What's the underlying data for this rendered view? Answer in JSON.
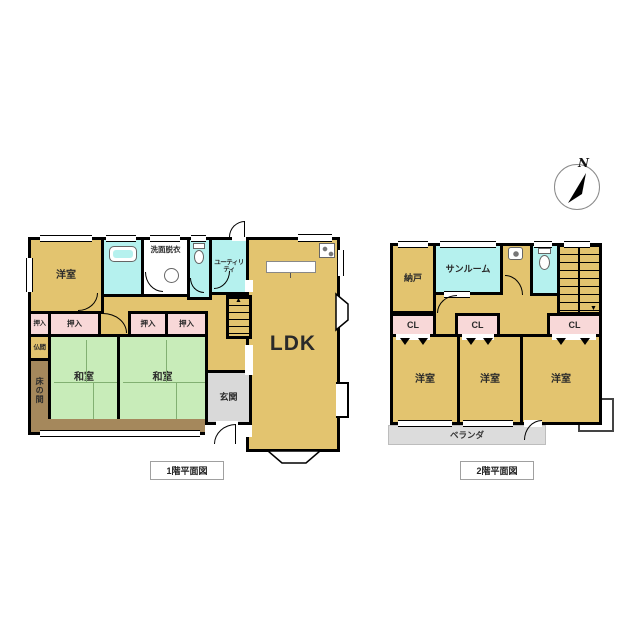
{
  "compass": {
    "label": "N"
  },
  "colors": {
    "wall": "#000000",
    "room_tan": "#e3c46f",
    "tatami_green": "#c8ecb9",
    "closet_pink": "#f8d8d8",
    "wet_cyan": "#b5f1ee",
    "wood_brown": "#a5885c",
    "entry_gray": "#d9d9d9",
    "background": "#ffffff"
  },
  "floor1": {
    "caption": "1階平面図",
    "rooms": {
      "yoshitsu": "洋室",
      "senmen": "洗面脱衣",
      "utility": "ユーティリティ",
      "ldk": "LDK",
      "oshiire": "押入",
      "butsuma": "仏間",
      "tokonoma": "床の間",
      "washitsu": "和室",
      "genkan": "玄関"
    }
  },
  "floor2": {
    "caption": "2階平面図",
    "rooms": {
      "nando": "納戸",
      "sunroom": "サンルーム",
      "closet": "CL",
      "yoshitsu": "洋室",
      "veranda": "ベランダ"
    }
  },
  "stairs": {
    "up": "▲",
    "down": "▼"
  }
}
